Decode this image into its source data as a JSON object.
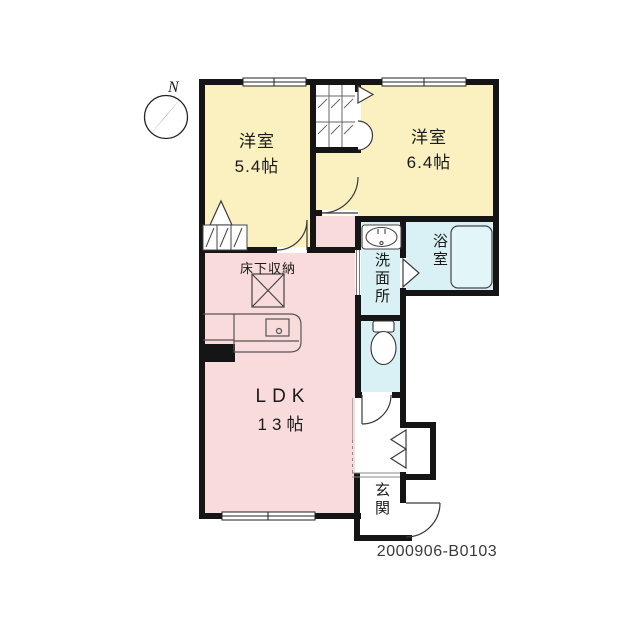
{
  "compass": {
    "label": "N"
  },
  "plan": {
    "number": "2000906-B0103",
    "rooms": {
      "bedroom1": {
        "name": "洋室",
        "size": "5.4帖"
      },
      "bedroom2": {
        "name": "洋室",
        "size": "6.4帖"
      },
      "ldk": {
        "name": "LDK",
        "size": "13帖"
      },
      "washroom": {
        "name": "洗面所"
      },
      "bathroom": {
        "name": "浴室"
      },
      "entrance": {
        "name": "玄関"
      },
      "underfloor_storage": {
        "name": "床下収納"
      }
    },
    "colors": {
      "bedroom": "#faf0c0",
      "ldk": "#f8dbda",
      "wet_area": "#d9f0f4",
      "bathtub": "#e2f5f8",
      "wall": "#151515"
    }
  }
}
